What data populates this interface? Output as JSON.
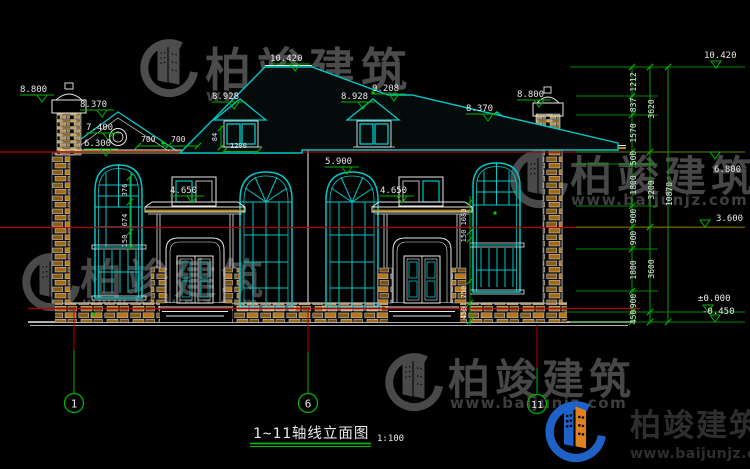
{
  "watermark": {
    "brand": "柏竣建筑",
    "url": "www.baijunjz.com"
  },
  "title_block": {
    "title": "1~11轴线立面图",
    "scale": "1:100"
  },
  "axis_bubbles": {
    "a1": "1",
    "a6": "6",
    "a11": "11"
  },
  "levels": {
    "left": [
      "8.800",
      "8.370",
      "7.400",
      "6.300"
    ],
    "roof": [
      "10.420",
      "8.928",
      "8.928",
      "9.208"
    ],
    "right_side": [
      "8.370",
      "8.800"
    ],
    "eave": "5.900",
    "canopy": [
      "4.650",
      "4.650"
    ],
    "margin": [
      "10.420",
      "6.800",
      "3.600",
      "±0.000",
      "-0.450"
    ]
  },
  "dims": {
    "roof_left": [
      "700",
      "700"
    ],
    "dormer_width": "1200",
    "dormer_sill": "84",
    "window_left": [
      "376",
      "674",
      "150"
    ],
    "porch_right": [
      "1080",
      "150",
      "750",
      "450"
    ],
    "chain_inner": [
      "1212",
      "837",
      "1570",
      "500",
      "1800",
      "900",
      "900",
      "1800",
      "900",
      "450"
    ],
    "chain_mid": [
      "3620",
      "3200",
      "3600"
    ],
    "chain_outer": "10870"
  },
  "colors": {
    "cad_cyan": "#00c8c8",
    "cad_green": "#00b400",
    "cad_red": "#b40000",
    "cad_white": "#e9e9e9",
    "stone_tan": "#b8860b",
    "logo_blue": "#1e62c8",
    "logo_orange": "#e08020",
    "watermark_gray": "#606060"
  }
}
